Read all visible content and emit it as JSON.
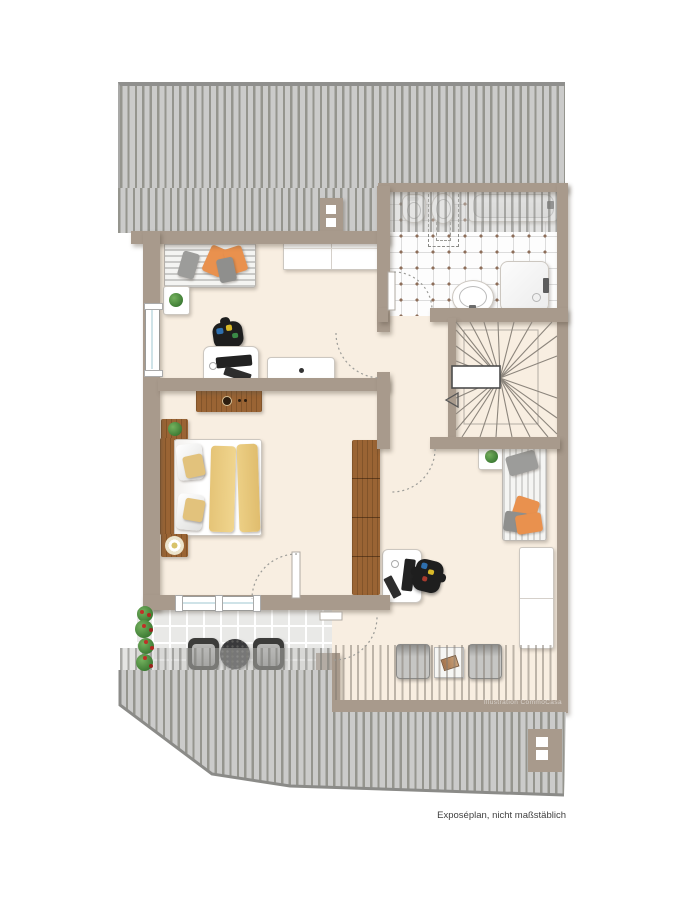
{
  "caption": "Exposéplan, nicht maßstäblich",
  "watermark": "Illustration CommoCasa",
  "palette": {
    "wall": "#a89a8c",
    "floor": "#f8eee1",
    "roofBase": "#cbcbca",
    "roofStripe": "#95958e",
    "tileDot": "#8d6e5a",
    "terrTile": "#e9e9e7",
    "wood": "#9a6434",
    "orange": "#e9914e",
    "caption_color": "#3f3f3f"
  }
}
